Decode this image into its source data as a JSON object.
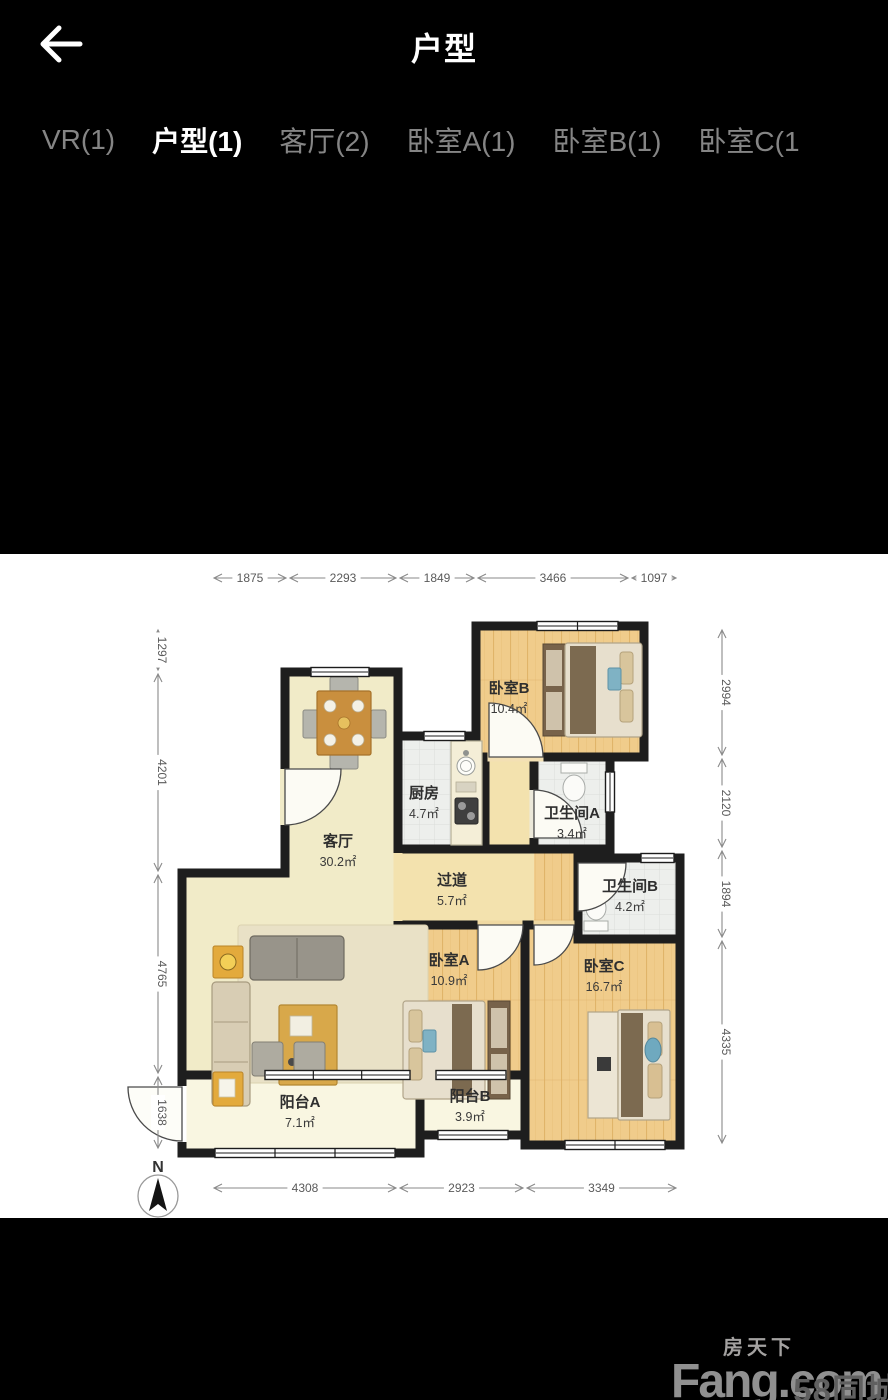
{
  "header": {
    "title": "户型"
  },
  "icons": {
    "back": "arrow-left-icon",
    "compass": "compass-north-icon"
  },
  "tabs": [
    {
      "label": "VR(1)",
      "active": false
    },
    {
      "label": "户型(1)",
      "active": true
    },
    {
      "label": "客厅(2)",
      "active": false
    },
    {
      "label": "卧室A(1)",
      "active": false
    },
    {
      "label": "卧室B(1)",
      "active": false
    },
    {
      "label": "卧室C(1",
      "active": false
    }
  ],
  "floorplan": {
    "compass_label": "N",
    "rooms": [
      {
        "id": "living",
        "name": "客厅",
        "area": "30.2㎡"
      },
      {
        "id": "kitchen",
        "name": "厨房",
        "area": "4.7㎡"
      },
      {
        "id": "hall",
        "name": "过道",
        "area": "5.7㎡"
      },
      {
        "id": "bedA",
        "name": "卧室A",
        "area": "10.9㎡"
      },
      {
        "id": "bedB",
        "name": "卧室B",
        "area": "10.4㎡"
      },
      {
        "id": "bedC",
        "name": "卧室C",
        "area": "16.7㎡"
      },
      {
        "id": "bathA",
        "name": "卫生间A",
        "area": "3.4㎡"
      },
      {
        "id": "bathB",
        "name": "卫生间B",
        "area": "4.2㎡"
      },
      {
        "id": "balconyA",
        "name": "阳台A",
        "area": "7.1㎡"
      },
      {
        "id": "balconyB",
        "name": "阳台B",
        "area": "3.9㎡"
      }
    ],
    "dimensions": {
      "top": [
        "1875",
        "2293",
        "1849",
        "3466",
        "1097"
      ],
      "bottom": [
        "4308",
        "2923",
        "3349"
      ],
      "left": [
        "1297",
        "4201",
        "4765",
        "1638"
      ],
      "right": [
        "2994",
        "2120",
        "1894",
        "4335"
      ]
    }
  },
  "watermark": {
    "brand_cn": "房天下",
    "brand_en": "Fang.com",
    "partner": "58同城"
  }
}
